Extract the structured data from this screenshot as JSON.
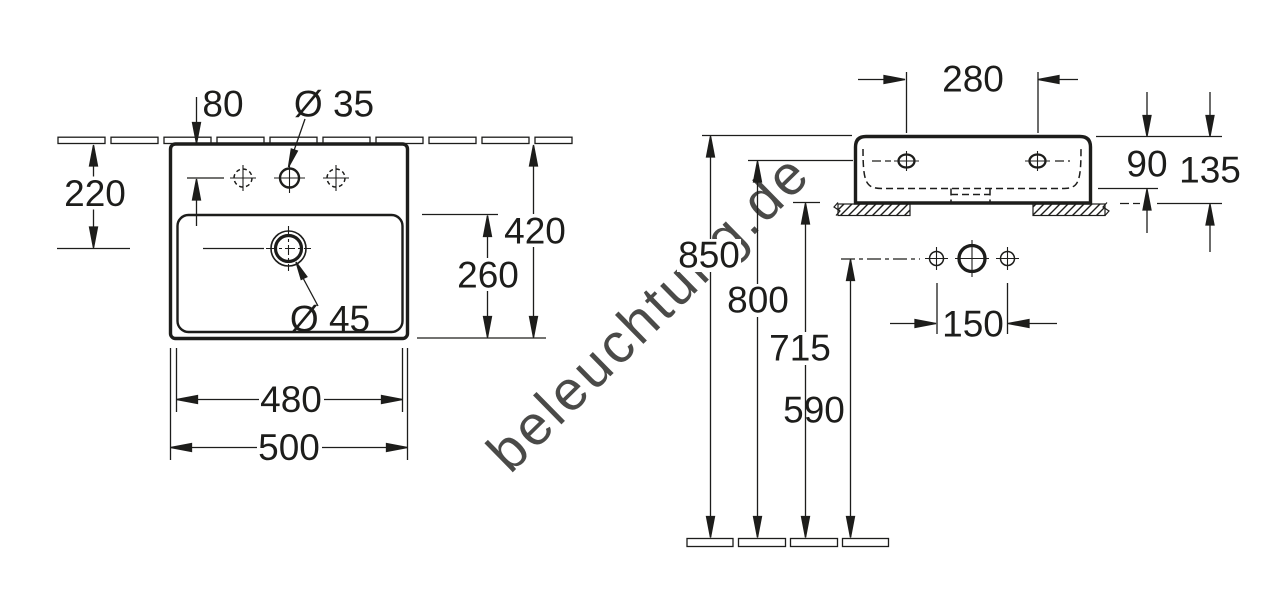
{
  "watermark": {
    "text": "beleuchtung.de"
  },
  "colors": {
    "line": "#1d1d1b",
    "background": "#ffffff",
    "watermark": "#d6d6d6"
  },
  "front_view": {
    "dims": {
      "tap_hole_offset": "80",
      "tap_hole_diameter": "Ø 35",
      "rim_to_drain": "220",
      "overall_depth": "420",
      "bowl_depth": "260",
      "drain_diameter": "Ø 45",
      "bowl_width": "480",
      "overall_width": "500"
    }
  },
  "side_view": {
    "dims": {
      "hole_spacing": "280",
      "bowl_inner_depth": "90",
      "body_height": "135",
      "rim_height": "850",
      "tap_line_height": "800",
      "underside_height": "715",
      "drain_height": "590",
      "outlet_spacing": "150"
    }
  }
}
